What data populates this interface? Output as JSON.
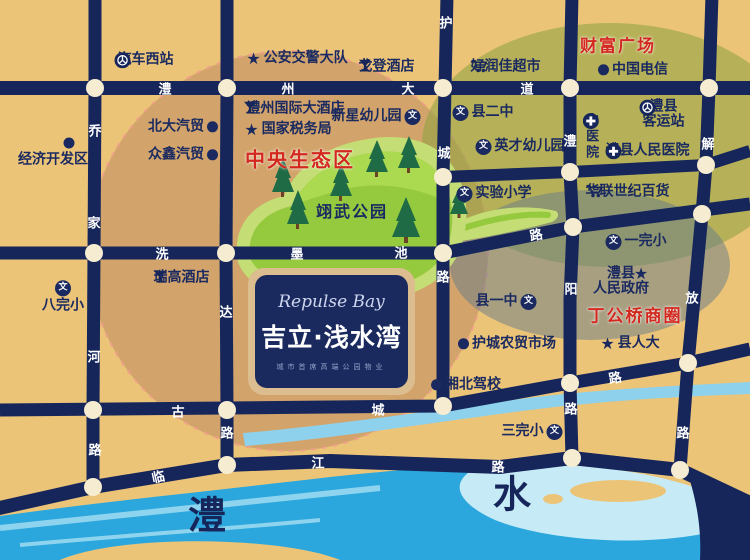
{
  "map": {
    "project": {
      "title_en": "Repulse Bay",
      "title_cn": "吉立·浅水湾",
      "tagline": "城市首席高端公园物业"
    },
    "park_label": "翊武公园",
    "district_labels": [
      {
        "id": "central-eco-zone",
        "text": "中央生态区",
        "x": 300,
        "y": 158,
        "size": 20
      },
      {
        "id": "wealth-plaza",
        "text": "财富广场",
        "x": 618,
        "y": 44,
        "size": 17
      },
      {
        "id": "dinggongqiao-business-circle",
        "text": "丁公桥商圈",
        "x": 635,
        "y": 314,
        "size": 17
      }
    ],
    "river_labels": [
      {
        "id": "river-li",
        "text": "澧",
        "x": 207,
        "y": 512
      },
      {
        "id": "river-shui",
        "text": "水",
        "x": 512,
        "y": 491
      }
    ],
    "road_labels": [
      {
        "ch": "澧",
        "x": 165,
        "y": 88
      },
      {
        "ch": "州",
        "x": 288,
        "y": 88
      },
      {
        "ch": "大",
        "x": 408,
        "y": 88
      },
      {
        "ch": "道",
        "x": 527,
        "y": 88
      },
      {
        "ch": "洗",
        "x": 162,
        "y": 253
      },
      {
        "ch": "墨",
        "x": 297,
        "y": 253
      },
      {
        "ch": "池",
        "x": 401,
        "y": 252
      },
      {
        "ch": "路",
        "x": 536,
        "y": 234,
        "rot": -11
      },
      {
        "ch": "古",
        "x": 178,
        "y": 411
      },
      {
        "ch": "城",
        "x": 378,
        "y": 409
      },
      {
        "ch": "路",
        "x": 615,
        "y": 377,
        "rot": -10
      },
      {
        "ch": "临",
        "x": 158,
        "y": 476,
        "rot": -12
      },
      {
        "ch": "江",
        "x": 318,
        "y": 462
      },
      {
        "ch": "路",
        "x": 498,
        "y": 466
      },
      {
        "ch": "乔",
        "x": 95,
        "y": 130
      },
      {
        "ch": "家",
        "x": 94,
        "y": 222
      },
      {
        "ch": "河",
        "x": 94,
        "y": 356
      },
      {
        "ch": "路",
        "x": 95,
        "y": 449
      },
      {
        "ch": "达",
        "x": 226,
        "y": 311
      },
      {
        "ch": "路",
        "x": 227,
        "y": 432
      },
      {
        "ch": "护",
        "x": 446,
        "y": 22
      },
      {
        "ch": "城",
        "x": 444,
        "y": 152
      },
      {
        "ch": "路",
        "x": 443,
        "y": 276
      },
      {
        "ch": "澧",
        "x": 570,
        "y": 140
      },
      {
        "ch": "阳",
        "x": 571,
        "y": 288
      },
      {
        "ch": "路",
        "x": 571,
        "y": 408
      },
      {
        "ch": "解",
        "x": 708,
        "y": 143
      },
      {
        "ch": "放",
        "x": 692,
        "y": 297
      },
      {
        "ch": "路",
        "x": 683,
        "y": 432
      }
    ],
    "pois": [
      {
        "id": "auto-west-station",
        "icon": "bus",
        "side": "left",
        "x": 144,
        "y": 60,
        "lines": [
          "汽车西站"
        ]
      },
      {
        "id": "econ-dev-zone-dot",
        "icon": "dot",
        "x": 69,
        "y": 143,
        "lines": []
      },
      {
        "id": "econ-dev-zone",
        "x": 53,
        "y": 160,
        "lines": [
          "经济开发区"
        ]
      },
      {
        "id": "beida-auto",
        "icon": "dot",
        "side": "right",
        "x": 183,
        "y": 127,
        "lines": [
          "北大汽贸"
        ]
      },
      {
        "id": "zhongxin-auto",
        "icon": "dot",
        "side": "right",
        "x": 183,
        "y": 155,
        "lines": [
          "众鑫汽贸"
        ]
      },
      {
        "id": "police-traffic-brigade",
        "icon": "star",
        "side": "left",
        "x": 297,
        "y": 59,
        "lines": [
          "公安交警大队"
        ]
      },
      {
        "id": "gordon-hotel",
        "icon": "glass",
        "side": "right",
        "x": 388,
        "y": 67,
        "lines": [
          "戈登酒店"
        ]
      },
      {
        "id": "lizhou-intl-hotel",
        "icon": "glass",
        "side": "left",
        "x": 294,
        "y": 109,
        "lines": [
          "澧州国际大酒店"
        ]
      },
      {
        "id": "national-tax-bureau",
        "icon": "star",
        "side": "left",
        "x": 288,
        "y": 130,
        "lines": [
          "国家税务局"
        ]
      },
      {
        "id": "xinxing-kindergarten",
        "icon": "school",
        "side": "right",
        "x": 376,
        "y": 117,
        "lines": [
          "新星幼儿园"
        ]
      },
      {
        "id": "ruigao-hotel",
        "icon": "glass",
        "side": "right",
        "x": 183,
        "y": 278,
        "lines": [
          "瑞高酒店"
        ]
      },
      {
        "id": "bawanxiao-school",
        "icon": "school",
        "side": "above",
        "x": 63,
        "y": 297,
        "lines": [
          "八完小"
        ]
      },
      {
        "id": "haorunjia-supermarket",
        "icon": "cart",
        "side": "right",
        "x": 507,
        "y": 67,
        "lines": [
          "好润佳超市"
        ]
      },
      {
        "id": "china-telecom",
        "icon": "dot",
        "side": "left",
        "x": 633,
        "y": 70,
        "lines": [
          "中国电信"
        ]
      },
      {
        "id": "county-no2-school",
        "icon": "school",
        "side": "left",
        "x": 483,
        "y": 113,
        "lines": [
          "县二中"
        ]
      },
      {
        "id": "yingcai-kindergarten",
        "icon": "school",
        "side": "left",
        "x": 520,
        "y": 147,
        "lines": [
          "英才幼儿园"
        ]
      },
      {
        "id": "shiyan-primary-school",
        "icon": "school",
        "side": "left",
        "x": 494,
        "y": 194,
        "lines": [
          "实验小学"
        ]
      },
      {
        "id": "lixian-bus-terminal",
        "icon": "bus",
        "side": "left",
        "x": 662,
        "y": 115,
        "lines": [
          "澧县",
          "客运站"
        ]
      },
      {
        "id": "tcm-hospital",
        "icon": "hospital",
        "side": "below",
        "vertical": true,
        "x": 590,
        "y": 138,
        "lines": [
          "中医院"
        ]
      },
      {
        "id": "lixian-peoples-hospital",
        "icon": "hospital",
        "side": "right",
        "x": 649,
        "y": 151,
        "lines": [
          "澧县人民医院"
        ]
      },
      {
        "id": "hualian-dept-store",
        "icon": "cart",
        "side": "right",
        "x": 629,
        "y": 192,
        "lines": [
          "华联世纪百货"
        ]
      },
      {
        "id": "yiwanxiao-school",
        "icon": "school",
        "side": "left",
        "x": 636,
        "y": 242,
        "lines": [
          "一完小"
        ]
      },
      {
        "id": "county-gov-star",
        "icon": "star",
        "x": 641,
        "y": 274,
        "lines": []
      },
      {
        "id": "lixian-peoples-government",
        "x": 621,
        "y": 282,
        "lines": [
          "澧县",
          "人民政府"
        ]
      },
      {
        "id": "county-peoples-congress",
        "icon": "star",
        "side": "left",
        "x": 630,
        "y": 344,
        "lines": [
          "县人大"
        ]
      },
      {
        "id": "county-no1-school",
        "icon": "school",
        "side": "right",
        "x": 506,
        "y": 302,
        "lines": [
          "县一中"
        ]
      },
      {
        "id": "hucheng-farm-market",
        "icon": "dot",
        "side": "left",
        "x": 507,
        "y": 344,
        "lines": [
          "护城农贸市场"
        ]
      },
      {
        "id": "xiangbei-driving-school",
        "icon": "dot",
        "side": "left",
        "x": 466,
        "y": 385,
        "lines": [
          "湘北驾校"
        ]
      },
      {
        "id": "sanwanxiao-school",
        "icon": "school",
        "side": "right",
        "x": 532,
        "y": 432,
        "lines": [
          "三完小"
        ]
      }
    ],
    "colors": {
      "road_navy": "#16265b",
      "sand": "#ecc478",
      "river_blue": "#2ba7dd",
      "park_green": "#95ca3e",
      "accent_red": "#d3281e",
      "node_cream": "#f6ecd2"
    }
  }
}
